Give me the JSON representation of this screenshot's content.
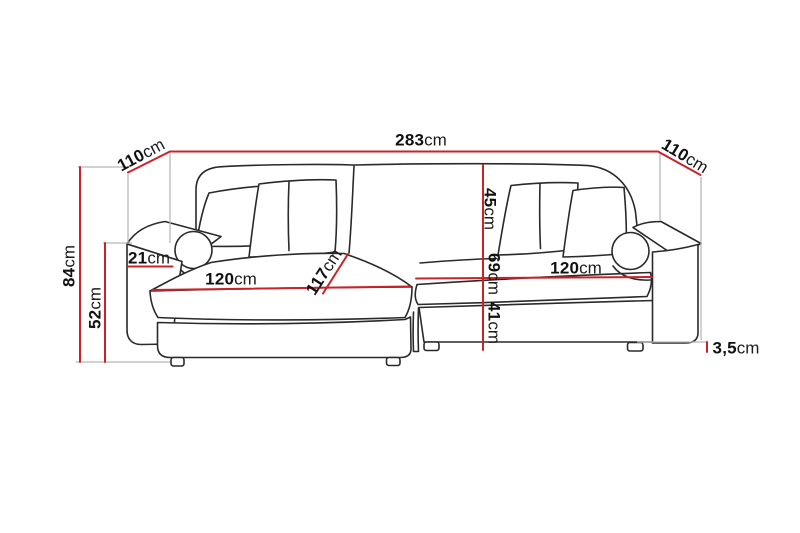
{
  "diagram": {
    "subject": "corner-sofa-dimension-drawing",
    "unit": "cm",
    "colors": {
      "dimension_line": "#c9232a",
      "extension_line": "#b8b8b8",
      "artwork_line": "#2a2a2a",
      "label_text": "#111111",
      "background": "#ffffff"
    },
    "dimensions": {
      "total_width": {
        "value": "283"
      },
      "depth_left": {
        "value": "110"
      },
      "depth_right": {
        "value": "110"
      },
      "total_height": {
        "value": "84"
      },
      "armrest_height": {
        "value": "52"
      },
      "armrest_width": {
        "value": "21"
      },
      "seat_width_left": {
        "value": "120"
      },
      "chaise_depth": {
        "value": "117"
      },
      "backrest_height": {
        "value": "45"
      },
      "seat_height": {
        "value": "69"
      },
      "base_height": {
        "value": "41"
      },
      "seat_width_right": {
        "value": "120"
      },
      "leg_height": {
        "value": "3,5"
      }
    }
  }
}
